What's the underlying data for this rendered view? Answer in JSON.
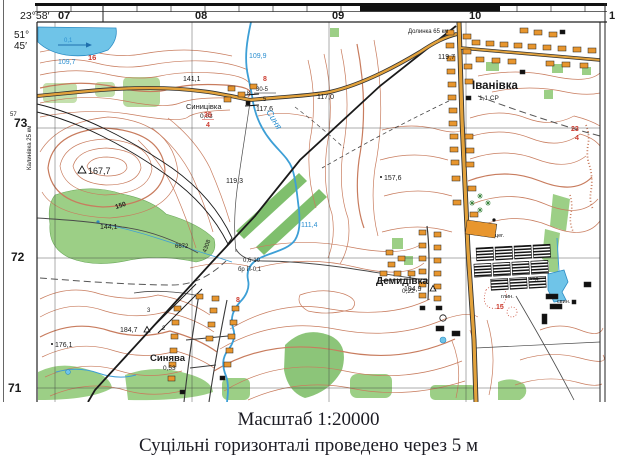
{
  "frame": {
    "lon_label": "23°58′",
    "lat_deg": "51°",
    "lat_min": "45′",
    "grid_cols": [
      "07",
      "08",
      "09",
      "10",
      "1"
    ],
    "grid_rows": [
      {
        "sup": "57",
        "label": "73"
      },
      {
        "label": "72"
      },
      {
        "label": "71"
      }
    ]
  },
  "destinations": {
    "left_rail": "Калинівка 25 км",
    "top_rail": "Долинка 65 км"
  },
  "settlements": [
    {
      "name": "Синицівка",
      "info": "0,03"
    },
    {
      "name": "Іванівка",
      "info": "1,1 СР"
    },
    {
      "name": "Демидівка",
      "info": "0,22"
    },
    {
      "name": "Синява",
      "info": "0,53"
    }
  ],
  "heights": [
    {
      "text": "141,1"
    },
    {
      "text": "117,6"
    },
    {
      "text": "117,0"
    },
    {
      "text": "119,3"
    },
    {
      "text": "144,1"
    },
    {
      "text": "167,7",
      "symbol": "triangulation"
    },
    {
      "text": "157,6"
    },
    {
      "text": "184,7",
      "symbol": "triangulation"
    },
    {
      "text": "176,1"
    },
    {
      "text": "194,9",
      "symbol": "triangulation"
    },
    {
      "text": "119,7"
    }
  ],
  "water_labels": [
    {
      "text": "109,7"
    },
    {
      "text": "109,9"
    },
    {
      "text": "111,4"
    },
    {
      "text": "0,1"
    },
    {
      "text": "Синя"
    }
  ],
  "red_labels": [
    "16",
    "8",
    "35",
    "4",
    "150",
    "8",
    "15",
    "23",
    "4"
  ],
  "object_labels": [
    {
      "text": "К"
    },
    {
      "text": "30-5"
    },
    {
      "text": "5"
    },
    {
      "text": "0,6-10"
    },
    {
      "text": "бр П-0,1"
    },
    {
      "text": "цег."
    },
    {
      "text": "глин."
    },
    {
      "text": "свин."
    },
    {
      "text": "вод."
    },
    {
      "text": "6672"
    },
    {
      "text": "4308"
    },
    {
      "text": "3"
    },
    {
      "text": "2"
    }
  ],
  "caption": {
    "line1": "Масштаб 1:20000",
    "line2": "Суцільні горизонталі проведено через 5 м"
  },
  "colors": {
    "contour": "#c87c5e",
    "water": "#3d9fd6",
    "water_fill": "#6fc4e8",
    "road": "#e2a23c",
    "forest": "#9ccf86",
    "scrub": "#c4e0ad",
    "red_label": "#cc3b2f",
    "building": "#e8962e"
  }
}
